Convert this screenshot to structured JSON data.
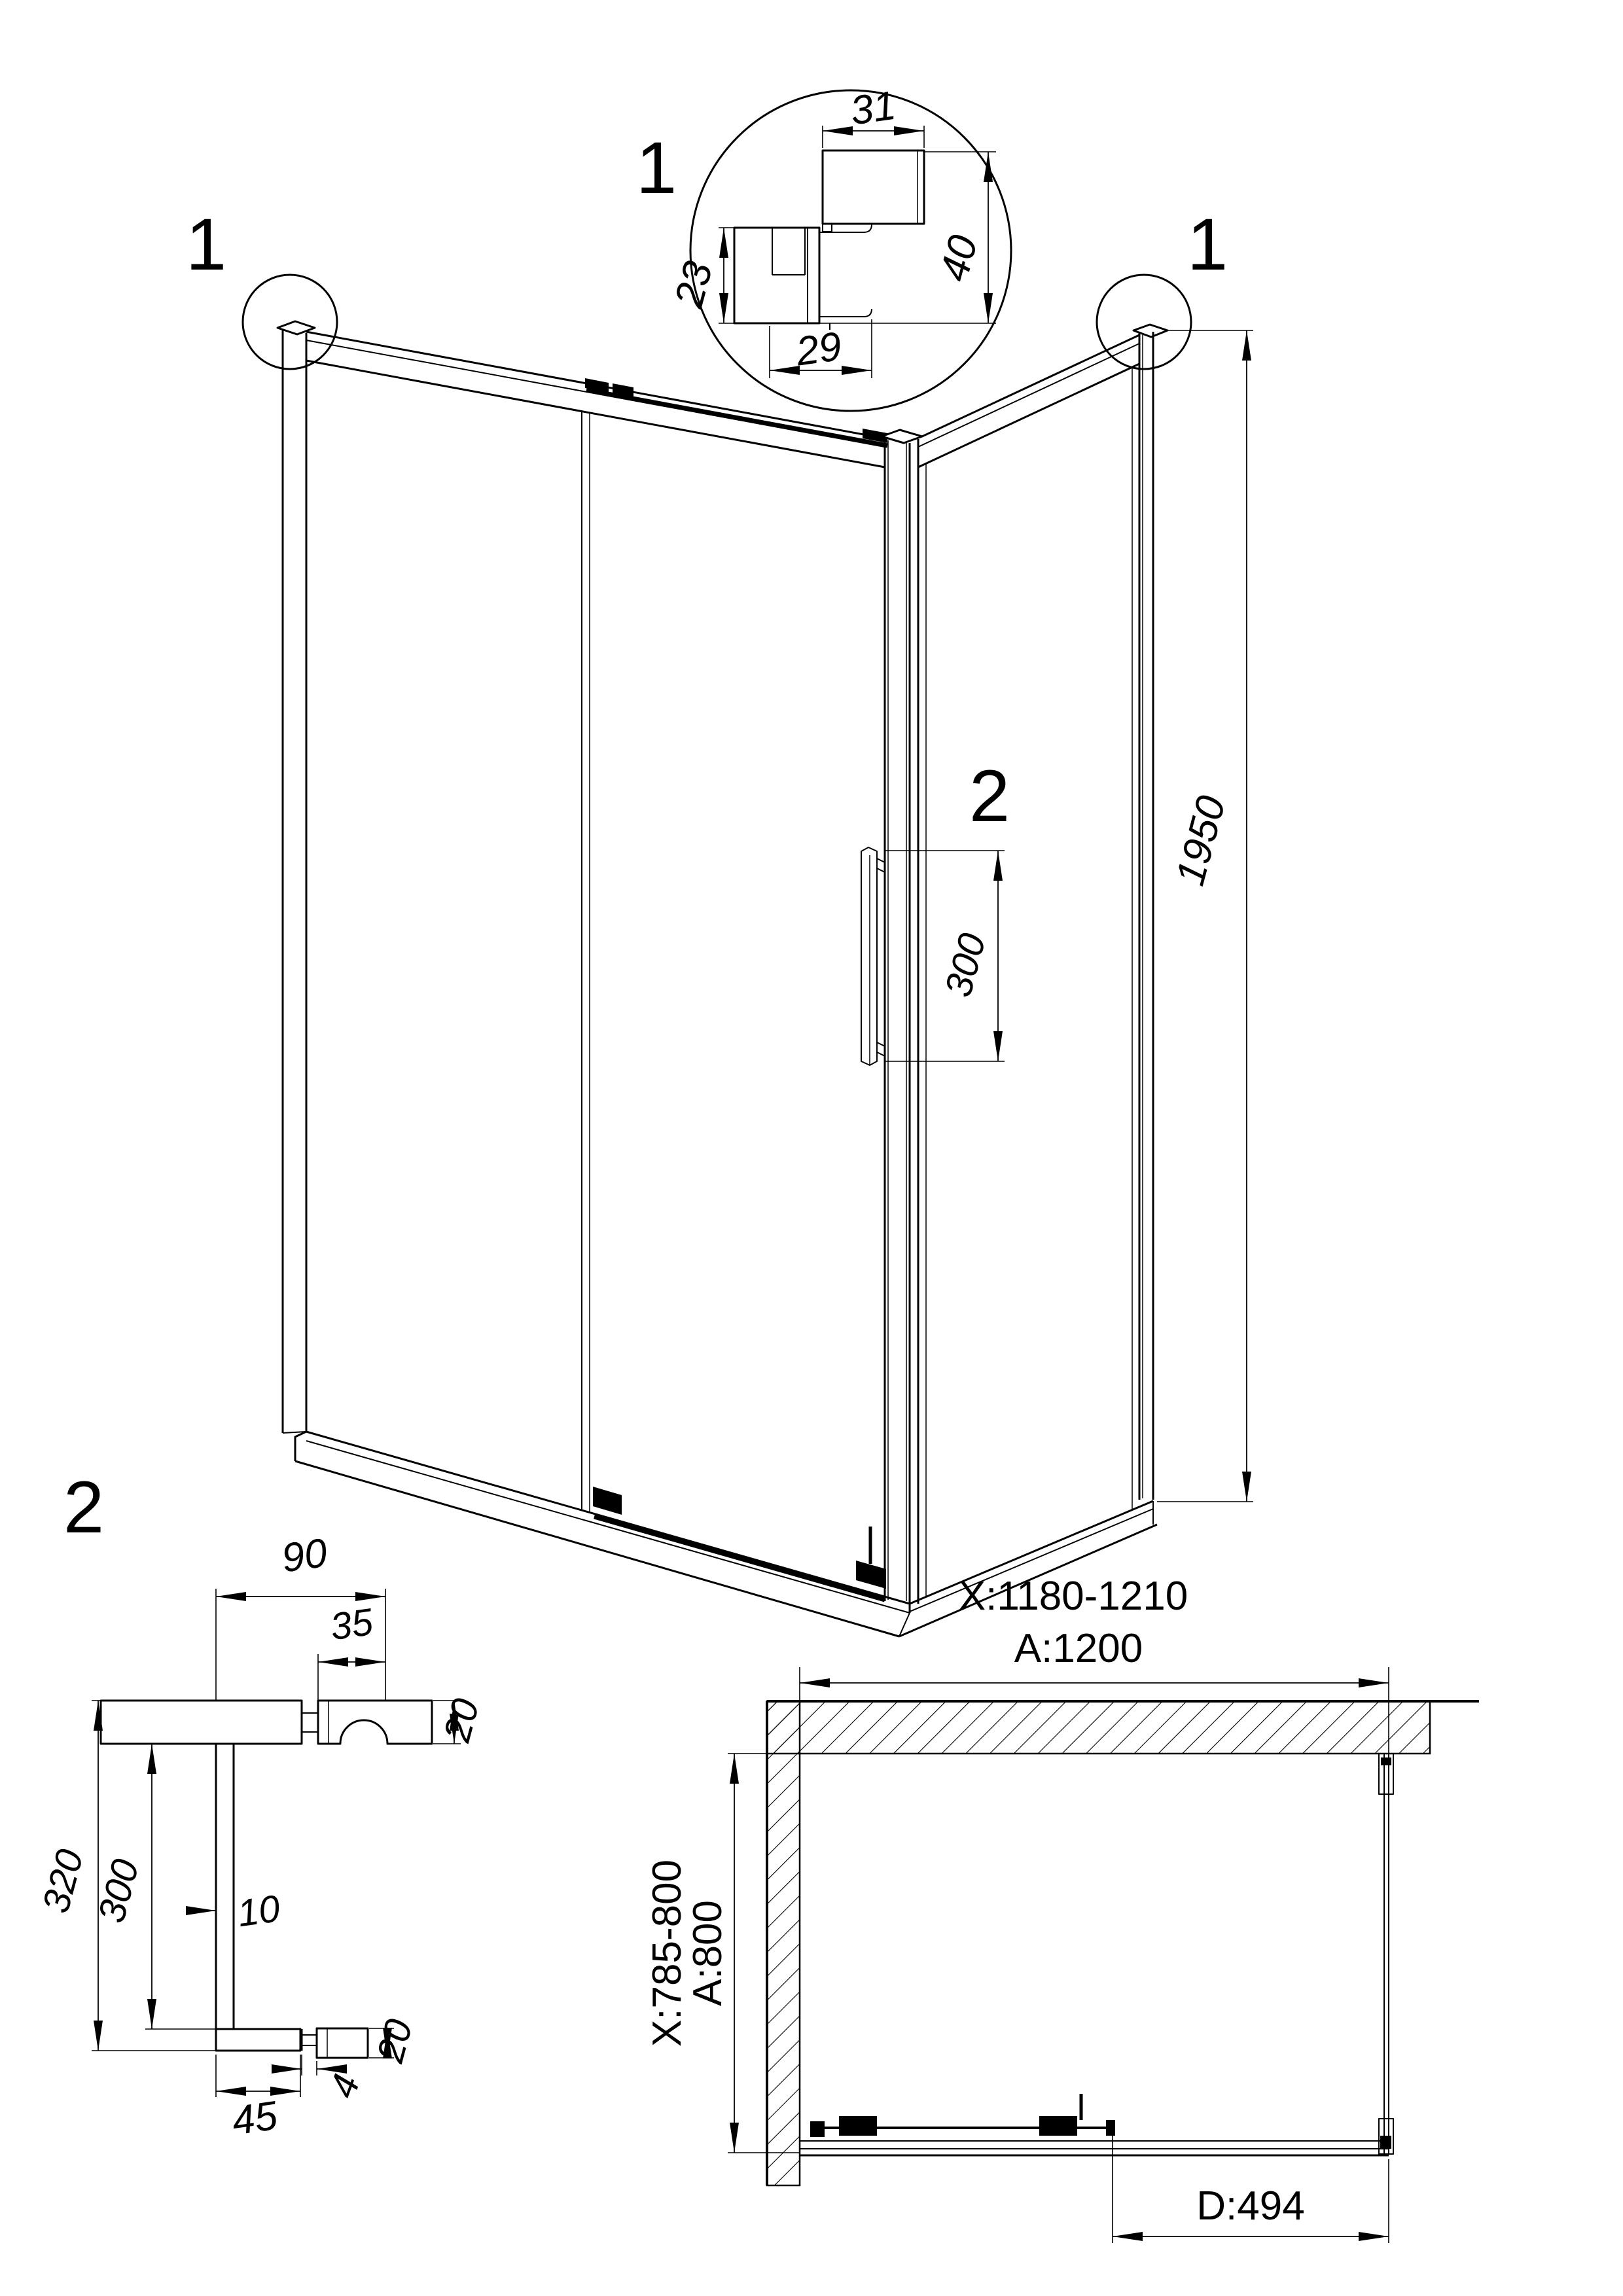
{
  "colors": {
    "ink": "#000000",
    "paper": "#ffffff"
  },
  "detail_profile": {
    "marker": "1",
    "dim_top": "31",
    "dim_right": "40",
    "dim_left": "23",
    "dim_bottom": "29"
  },
  "corner_markers": {
    "left": "1",
    "right": "1"
  },
  "main_view": {
    "height_dim": "1950",
    "handle_marker": "2",
    "handle_dim": "300"
  },
  "handle_detail": {
    "marker": "2",
    "arm_dim": "90",
    "knob_dim": "35",
    "knob_thickness_dim": "20",
    "length_dim": "320",
    "spacing_dim": "300",
    "bar_dim": "10",
    "foot_thickness_dim": "20",
    "stem_dim": "4",
    "foot_dim": "45"
  },
  "plan_view": {
    "width_range": "X:1180-1210",
    "width_nominal": "A:1200",
    "depth_range": "X:785-800",
    "depth_nominal": "A:800",
    "door_dim": "D:494"
  }
}
